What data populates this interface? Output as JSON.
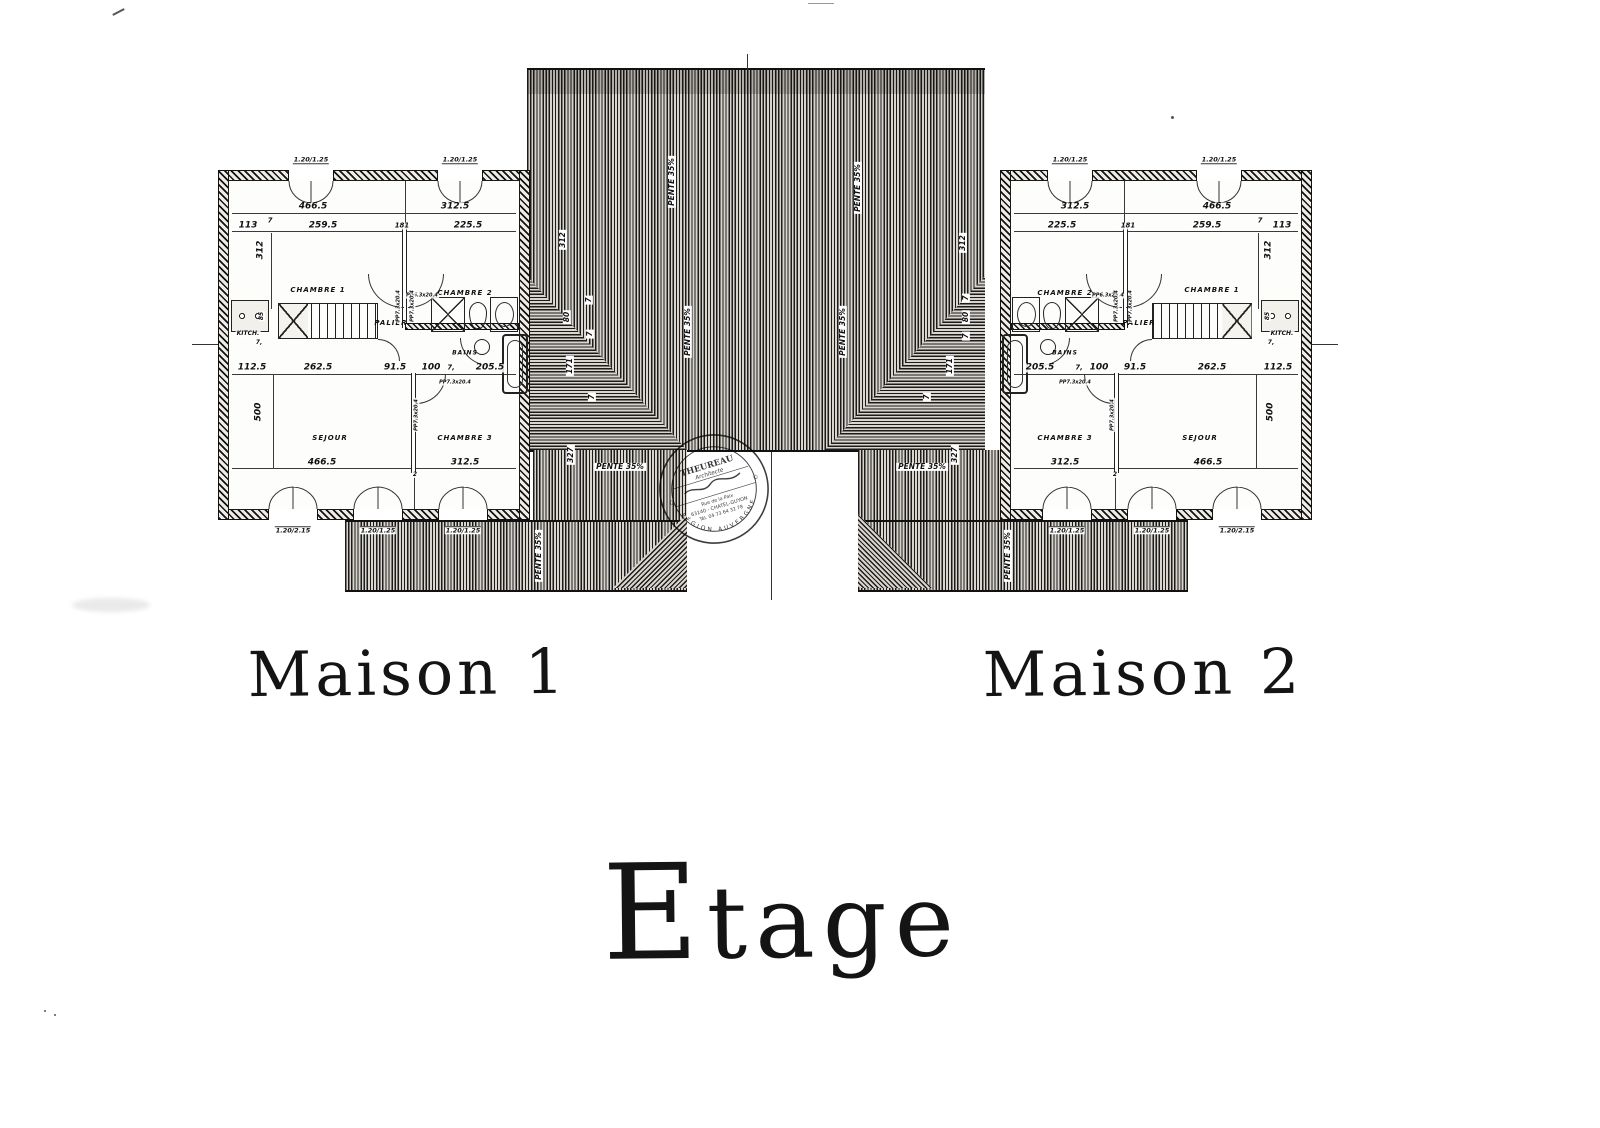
{
  "page": {
    "main_title": "Etage",
    "ink_color": "#1d1d1d",
    "paper_color": "#ffffff"
  },
  "titles": {
    "maison1": "Maison 1",
    "maison2": "Maison 2"
  },
  "stamp": {
    "line1": "THEUREAU",
    "line2": "Architecte",
    "line3": "Rue de la Paix",
    "line4": "63140 - CHATEL-GUYON",
    "line5": "Tél. 04 73 64 32 78",
    "arc_bottom": "RÉGION AUVERGNE",
    "star": "✩"
  },
  "roof": {
    "pieces": [
      {
        "cls": "hatch-v roof-band",
        "name": "roof-ridge-band",
        "x": 527,
        "y": 68,
        "w": 458,
        "h": 26
      },
      {
        "cls": "hatch-v roof-upper",
        "name": "roof-upper-slope",
        "x": 527,
        "y": 94,
        "w": 458,
        "h": 180
      },
      {
        "cls": "hatch-v roof-lower",
        "name": "roof-lower-slope",
        "x": 527,
        "y": 274,
        "w": 458,
        "h": 176
      },
      {
        "cls": "hatch-h hip",
        "name": "roof-hip-left",
        "x": 527,
        "y": 276,
        "w": 160,
        "h": 174,
        "clip": "polygon(0 0,100% 100%,0 100%)"
      },
      {
        "cls": "hatch-h hip",
        "name": "roof-hip-right",
        "x": 825,
        "y": 276,
        "w": 160,
        "h": 174,
        "clip": "polygon(100% 0,0 100%,100% 100%)"
      },
      {
        "cls": "hatch-v flank",
        "name": "roof-flank-left",
        "x": 533,
        "y": 450,
        "w": 154,
        "h": 72
      },
      {
        "cls": "hatch-v flank",
        "name": "roof-flank-right",
        "x": 858,
        "y": 450,
        "w": 152,
        "h": 72
      },
      {
        "cls": "hatch-v wing",
        "name": "roof-wing-left",
        "x": 345,
        "y": 520,
        "w": 342,
        "h": 68
      },
      {
        "cls": "hatch-v wing",
        "name": "roof-wing-right",
        "x": 858,
        "y": 520,
        "w": 330,
        "h": 68
      },
      {
        "cls": "hatch-d135 fan",
        "name": "roof-valley-left",
        "x": 613,
        "y": 514,
        "w": 74,
        "h": 74,
        "clip": "polygon(100% 0,100% 100%,0 100%)"
      },
      {
        "cls": "hatch-d45 fan",
        "name": "roof-valley-right",
        "x": 858,
        "y": 514,
        "w": 74,
        "h": 74,
        "clip": "polygon(0 0,0 100%,100% 100%)"
      }
    ],
    "lines": [
      {
        "name": "party-line",
        "x": 771,
        "y": 452,
        "w": 1,
        "h": 148
      },
      {
        "name": "ridge-tick",
        "x": 747,
        "y": 54,
        "w": 1,
        "h": 16
      },
      {
        "name": "ref-line-left",
        "x": 192,
        "y": 344,
        "w": 28,
        "h": 1
      },
      {
        "name": "ref-line-right",
        "x": 1310,
        "y": 344,
        "w": 28,
        "h": 1
      }
    ],
    "labels": [
      {
        "t": "PENTE 35%",
        "x": 672,
        "y": 182,
        "r": -90
      },
      {
        "t": "PENTE 35%",
        "x": 858,
        "y": 188,
        "r": -90
      },
      {
        "t": "312",
        "x": 563,
        "y": 240,
        "r": -90
      },
      {
        "t": "312",
        "x": 963,
        "y": 243,
        "r": -90
      },
      {
        "t": "PENTE 35%",
        "x": 688,
        "y": 332,
        "r": -90
      },
      {
        "t": "PENTE 35%",
        "x": 843,
        "y": 332,
        "r": -90
      },
      {
        "t": "80",
        "x": 567,
        "y": 317,
        "r": -90
      },
      {
        "t": "7",
        "x": 589,
        "y": 300,
        "r": -90
      },
      {
        "t": "7",
        "x": 590,
        "y": 334,
        "r": -90
      },
      {
        "t": "171",
        "x": 570,
        "y": 366,
        "r": -90
      },
      {
        "t": "7",
        "x": 592,
        "y": 397,
        "r": -90
      },
      {
        "t": "327",
        "x": 571,
        "y": 455,
        "r": -90
      },
      {
        "t": "7",
        "x": 966,
        "y": 298,
        "r": -90
      },
      {
        "t": "80",
        "x": 966,
        "y": 317,
        "r": -90
      },
      {
        "t": "7",
        "x": 966,
        "y": 336,
        "r": -90
      },
      {
        "t": "171",
        "x": 950,
        "y": 366,
        "r": -90
      },
      {
        "t": "7",
        "x": 927,
        "y": 397,
        "r": -90
      },
      {
        "t": "327",
        "x": 955,
        "y": 455,
        "r": -90
      },
      {
        "t": "PENTE 35%",
        "x": 620,
        "y": 467,
        "r": 0
      },
      {
        "t": "PENTE 35%",
        "x": 922,
        "y": 467,
        "r": 0
      },
      {
        "t": "PENTE 35%",
        "x": 539,
        "y": 556,
        "r": -90
      },
      {
        "t": "PENTE 35%",
        "x": 1008,
        "y": 556,
        "r": -90
      }
    ]
  },
  "houses": [
    {
      "name": "Maison 1",
      "x": 218,
      "y": 170,
      "mirror": false
    },
    {
      "name": "Maison 2",
      "x": 1000,
      "y": 170,
      "mirror": true
    }
  ],
  "house_plan": {
    "w": 312,
    "h": 350,
    "wall": 11,
    "windows_top": [
      {
        "x": 70,
        "w": 46,
        "label": "1.20/1.25"
      },
      {
        "x": 219,
        "w": 46,
        "label": "1.20/1.25"
      }
    ],
    "windows_bottom": [
      {
        "x": 50,
        "w": 50,
        "label": "1.20/2.15"
      },
      {
        "x": 135,
        "w": 50,
        "label": "1.20/1.25"
      },
      {
        "x": 220,
        "w": 50,
        "label": "1.20/1.25"
      }
    ],
    "labels": [
      {
        "t": "466.5",
        "x": 95,
        "y": 37
      },
      {
        "t": "312.5",
        "x": 237,
        "y": 37
      },
      {
        "t": "113",
        "x": 30,
        "y": 56
      },
      {
        "t": "7",
        "x": 52,
        "y": 51,
        "s": 7
      },
      {
        "t": "259.5",
        "x": 105,
        "y": 56
      },
      {
        "t": "181",
        "x": 184,
        "y": 56,
        "s": 7
      },
      {
        "t": "225.5",
        "x": 250,
        "y": 56
      },
      {
        "t": "312",
        "x": 43,
        "y": 80,
        "r": -90
      },
      {
        "t": "CHAMBRE 1",
        "x": 100,
        "y": 120,
        "cls": "room"
      },
      {
        "t": "CHAMBRE 2",
        "x": 247,
        "y": 123,
        "cls": "room"
      },
      {
        "t": "PALIER",
        "x": 173,
        "y": 153,
        "cls": "room"
      },
      {
        "t": "KITCH.",
        "x": 30,
        "y": 164,
        "s": 6
      },
      {
        "t": "85",
        "x": 44,
        "y": 146,
        "r": -90,
        "s": 6
      },
      {
        "t": "7,",
        "x": 41,
        "y": 173,
        "s": 6
      },
      {
        "t": "BAINS",
        "x": 247,
        "y": 183,
        "cls": "room",
        "s": 6
      },
      {
        "t": "PP6.3x20.4",
        "x": 204,
        "y": 126,
        "cls": "tiny"
      },
      {
        "t": "PP7.3x20.4",
        "x": 181,
        "y": 136,
        "r": -90,
        "cls": "tiny"
      },
      {
        "t": "PP7.3x20.4",
        "x": 195,
        "y": 136,
        "r": -90,
        "cls": "tiny"
      },
      {
        "t": "112.5",
        "x": 34,
        "y": 198
      },
      {
        "t": "262.5",
        "x": 100,
        "y": 198
      },
      {
        "t": "91.5",
        "x": 177,
        "y": 198
      },
      {
        "t": "100",
        "x": 213,
        "y": 198
      },
      {
        "t": "7,",
        "x": 233,
        "y": 198,
        "s": 7
      },
      {
        "t": "205.5",
        "x": 272,
        "y": 198
      },
      {
        "t": "PP7.3x20.4",
        "x": 237,
        "y": 213,
        "cls": "tiny"
      },
      {
        "t": "PP7.3x20.4",
        "x": 199,
        "y": 245,
        "r": -90,
        "cls": "tiny"
      },
      {
        "t": "500",
        "x": 41,
        "y": 242,
        "r": -90
      },
      {
        "t": "SEJOUR",
        "x": 112,
        "y": 268,
        "cls": "room"
      },
      {
        "t": "CHAMBRE 3",
        "x": 247,
        "y": 268,
        "cls": "room"
      },
      {
        "t": "466.5",
        "x": 104,
        "y": 293
      },
      {
        "t": "312.5",
        "x": 247,
        "y": 293
      },
      {
        "t": "2",
        "x": 197,
        "y": 305,
        "s": 6
      }
    ],
    "features": [
      {
        "cls": "dimline",
        "x": 14,
        "y": 43,
        "w": 284,
        "h": 1
      },
      {
        "cls": "dimline",
        "x": 14,
        "y": 61,
        "w": 284,
        "h": 1
      },
      {
        "cls": "dimline",
        "x": 14,
        "y": 204,
        "w": 284,
        "h": 1
      },
      {
        "cls": "dimline",
        "x": 14,
        "y": 298,
        "w": 284,
        "h": 1
      },
      {
        "cls": "vline",
        "x": 53,
        "y": 63,
        "w": 1,
        "h": 76
      },
      {
        "cls": "vline",
        "x": 55,
        "y": 205,
        "w": 1,
        "h": 93
      },
      {
        "cls": "vline",
        "x": 187,
        "y": 11,
        "w": 1,
        "h": 50
      },
      {
        "cls": "vline",
        "x": 196,
        "y": 300,
        "w": 1,
        "h": 39
      },
      {
        "cls": "dline-v",
        "x": 184,
        "y": 58,
        "w": 5,
        "h": 100
      },
      {
        "cls": "dline-v",
        "x": 193,
        "y": 203,
        "w": 5,
        "h": 100
      },
      {
        "cls": "wallseg",
        "x": 187,
        "y": 153,
        "w": 114,
        "h": 7
      },
      {
        "cls": "stairs",
        "x": 60,
        "y": 133,
        "w": 100,
        "h": 36
      },
      {
        "cls": "kitchen",
        "x": 13,
        "y": 130,
        "w": 38,
        "h": 32
      },
      {
        "cls": "shower",
        "x": 213,
        "y": 127,
        "w": 34,
        "h": 35
      },
      {
        "cls": "wc",
        "x": 251,
        "y": 132,
        "w": 18,
        "h": 27
      },
      {
        "cls": "miniroom",
        "x": 272,
        "y": 127,
        "w": 28,
        "h": 35
      },
      {
        "cls": "sink",
        "x": 256,
        "y": 169,
        "w": 16,
        "h": 16
      },
      {
        "cls": "tub",
        "x": 284,
        "y": 164,
        "w": 26,
        "h": 60
      },
      {
        "cls": "arc-bl",
        "x": 150,
        "y": 104,
        "w": 36,
        "h": 34
      },
      {
        "cls": "arc-br",
        "x": 190,
        "y": 104,
        "w": 36,
        "h": 34
      },
      {
        "cls": "arc-br",
        "x": 198,
        "y": 204,
        "w": 30,
        "h": 30
      },
      {
        "cls": "arc-bl",
        "x": 242,
        "y": 168,
        "w": 30,
        "h": 28
      },
      {
        "cls": "arc-tr",
        "x": 160,
        "y": 169,
        "w": 22,
        "h": 22
      }
    ]
  }
}
